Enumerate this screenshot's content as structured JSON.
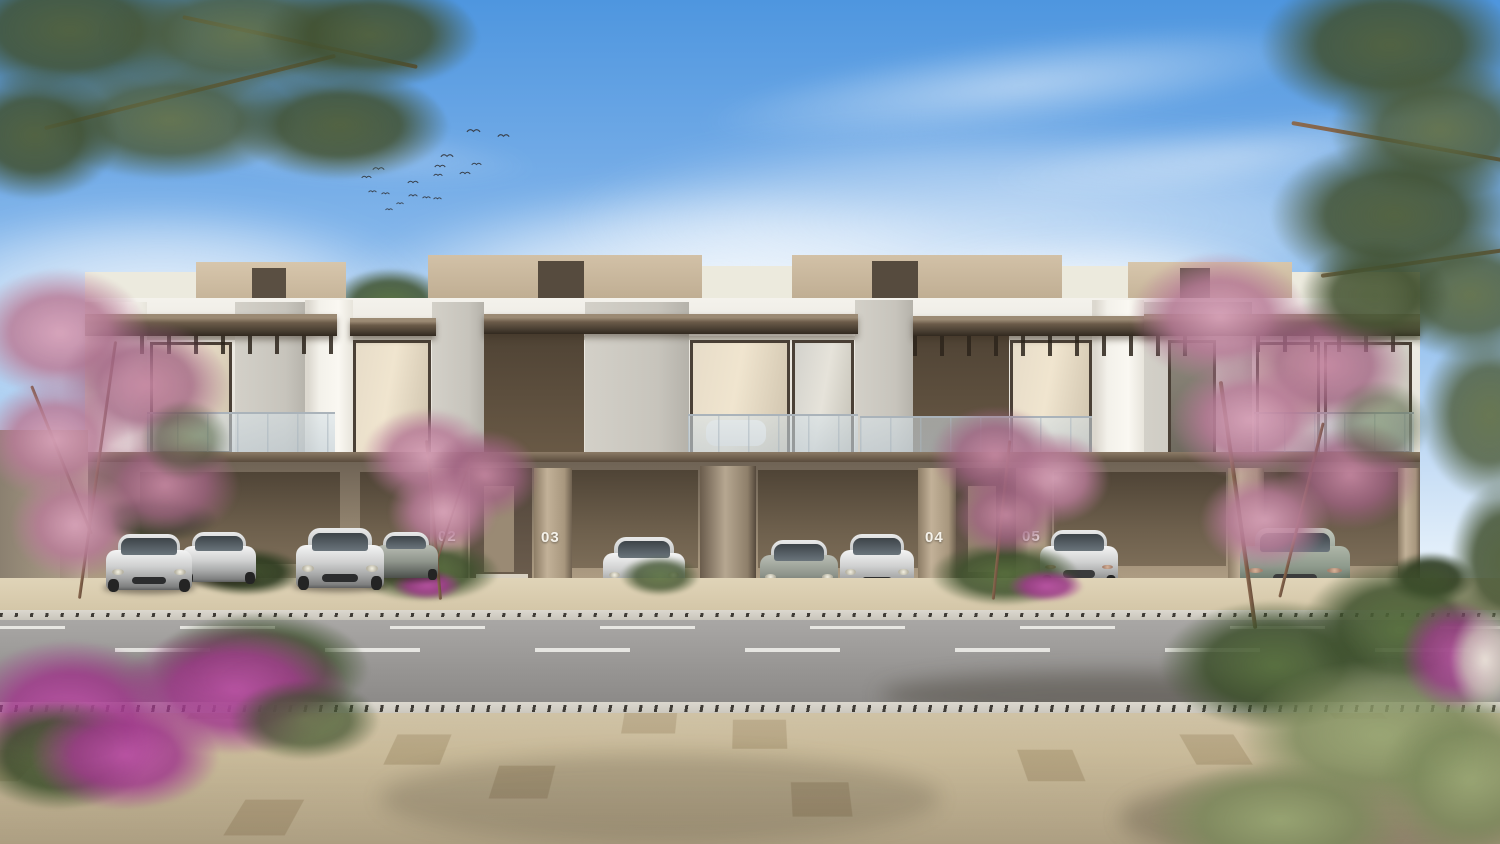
{
  "scene": {
    "type": "architectural-render",
    "description": "Street view of a modern two-storey townhouse row with open carports, luxury cars, pink flowering trees, pine branches, a road and a paved promenade under a blue sky",
    "time_of_day": "day"
  },
  "building": {
    "style": "contemporary townhouse row",
    "storeys": 2,
    "unit_numbers": [
      "02",
      "03",
      "04",
      "05"
    ],
    "carports": 5,
    "features": [
      "glass balconies",
      "bronze canopies",
      "vertical louver screens",
      "stone cladding",
      "wood slat carport walls"
    ]
  },
  "vehicles": {
    "count": 9,
    "types": [
      "sedan-front",
      "coupe-rear",
      "sedan-front",
      "sedan-side",
      "sports-front",
      "supercar-front",
      "sports-front",
      "sedan-rear",
      "supercar-rear"
    ]
  },
  "birds": {
    "count": 17
  },
  "road": {
    "lanes": 2,
    "lane_markings": "dashed",
    "marking_color": "#eeede9"
  },
  "colors": {
    "sky_top": "#4e96df",
    "sky_mid": "#9ac4ef",
    "sky_low": "#e9f3fb",
    "stone_white": "#f3f1ea",
    "roof_beige": "#c8b69c",
    "bronze_dark": "#3f362b",
    "glass_warm": "#f0e5cf",
    "slat_light": "#c9b691",
    "unit_number_color": "#f5f2ea",
    "lane_white": "#eeede9",
    "paver_light": "#d3c5a6",
    "blossom_pink": "#c994ab",
    "bougainvillea": "#b04c9e",
    "pine_green": "#51603c"
  }
}
